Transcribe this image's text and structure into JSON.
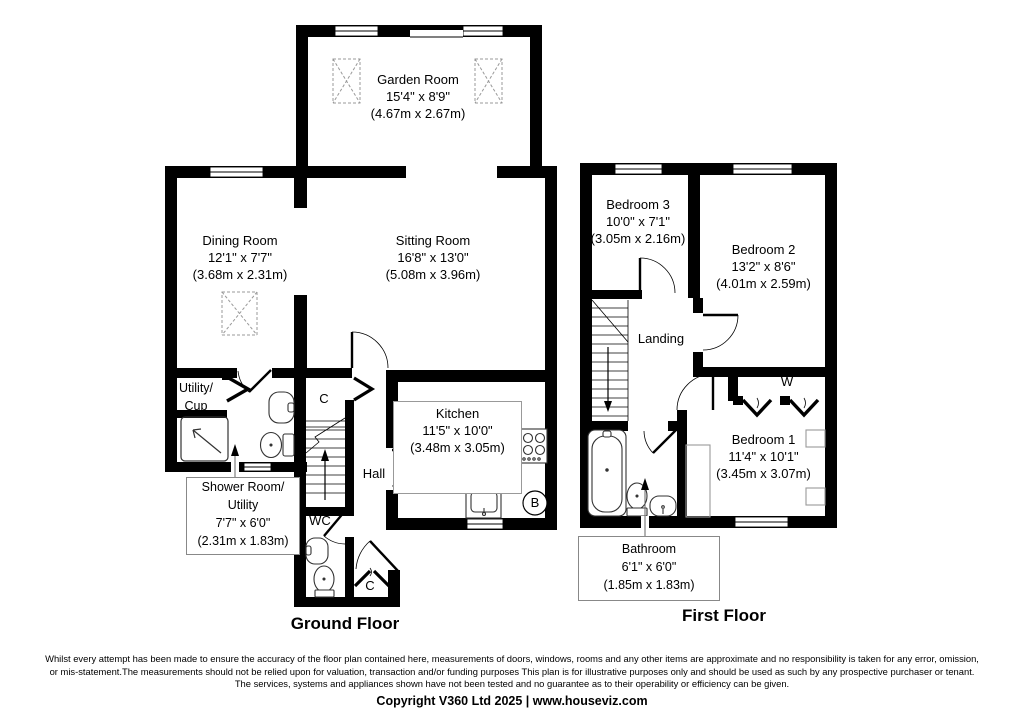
{
  "colors": {
    "wall": "#000000",
    "furniture_outline": "#999999",
    "label_box_border": "#888888",
    "skylight_outline": "#999999"
  },
  "icons": {
    "skylight": "skylight-icon",
    "stairs": "stairs-icon",
    "shower": "shower-icon",
    "toilet": "toilet-icon",
    "basin": "basin-icon",
    "bath": "bath-icon",
    "hob": "hob-icon",
    "sink": "sink-icon",
    "boiler": "boiler-icon",
    "door": "door-swing-icon",
    "window": "window-icon"
  },
  "ground_floor": {
    "title": "Ground Floor",
    "rooms": {
      "garden_room": {
        "name": "Garden Room",
        "size_imperial": "15'4\" x 8'9\"",
        "size_metric": "(4.67m x 2.67m)"
      },
      "dining_room": {
        "name": "Dining Room",
        "size_imperial": "12'1\" x 7'7\"",
        "size_metric": "(3.68m x 2.31m)"
      },
      "sitting_room": {
        "name": "Sitting Room",
        "size_imperial": "16'8\" x 13'0\"",
        "size_metric": "(5.08m x 3.96m)"
      },
      "kitchen": {
        "name": "Kitchen",
        "size_imperial": "11'5\" x 10'0\"",
        "size_metric": "(3.48m x 3.05m)"
      },
      "shower_room": {
        "name_line1": "Shower Room/",
        "name_line2": "Utility",
        "size_imperial": "7'7\" x 6'0\"",
        "size_metric": "(2.31m x 1.83m)"
      },
      "utility_cupboard": {
        "name_line1": "Utility/",
        "name_line2": "Cup"
      },
      "hall": {
        "name": "Hall"
      },
      "wc": {
        "name": "WC"
      }
    },
    "labels": {
      "cupboard_top": "C",
      "cupboard_bottom": "C",
      "boiler": "B"
    }
  },
  "first_floor": {
    "title": "First Floor",
    "rooms": {
      "bedroom_1": {
        "name": "Bedroom 1",
        "size_imperial": "11'4\" x 10'1\"",
        "size_metric": "(3.45m x 3.07m)"
      },
      "bedroom_2": {
        "name": "Bedroom 2",
        "size_imperial": "13'2\" x 8'6\"",
        "size_metric": "(4.01m x 2.59m)"
      },
      "bedroom_3": {
        "name": "Bedroom 3",
        "size_imperial": "10'0\" x 7'1\"",
        "size_metric": "(3.05m x 2.16m)"
      },
      "landing": {
        "name": "Landing"
      },
      "bathroom": {
        "name": "Bathroom",
        "size_imperial": "6'1\" x 6'0\"",
        "size_metric": "(1.85m x 1.83m)"
      }
    },
    "labels": {
      "wardrobe": "W"
    }
  },
  "footer": {
    "lines": [
      "Whilst every attempt has been made to ensure the accuracy of the floor plan contained here, measurements of doors, windows, rooms and any other items are approximate and no responsibility is taken for any error, omission,",
      "or mis-statement.The measurements should not be relied upon for valuation, transaction and/or funding purposes This plan is for illustrative purposes only and should be used as such by any prospective purchaser or tenant.",
      "The services, systems and appliances shown have not been tested and no guarantee as to their operability or efficiency can be given."
    ],
    "copyright": "Copyright V360 Ltd 2025 | www.houseviz.com"
  }
}
